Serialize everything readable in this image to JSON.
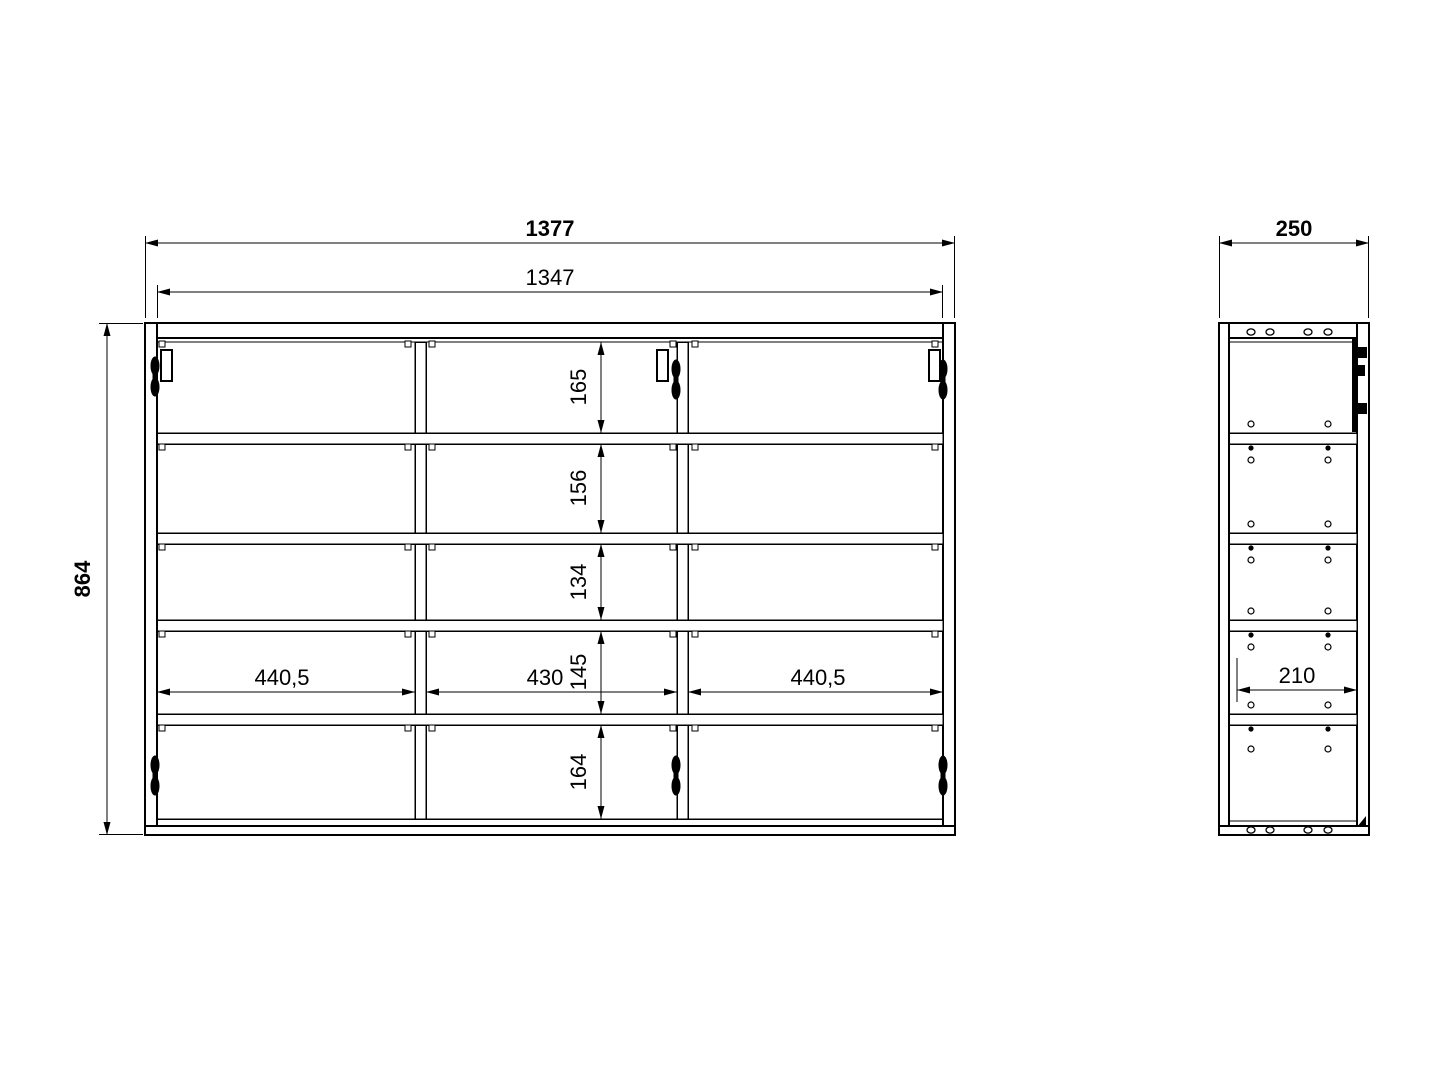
{
  "page": {
    "background": "#ffffff",
    "description": "Technical dimension drawing of a three-door wall cabinet, front view and side view"
  },
  "drawing": {
    "line_color": "#000000",
    "front_view": {
      "overall_width": "1377",
      "inner_width": "1347",
      "overall_height": "864",
      "row_heights": [
        "165",
        "156",
        "134",
        "145",
        "164"
      ],
      "compartment_widths": [
        "440,5",
        "430",
        "440,5"
      ]
    },
    "side_view": {
      "overall_depth": "250",
      "inner_depth": "210"
    }
  },
  "geometry": {
    "canvas": {
      "width": 1449,
      "height": 1086
    },
    "shapes": [
      [
        "rect",
        145,
        323,
        12,
        512,
        2,
        "front-left-side-panel"
      ],
      [
        "rect",
        943,
        323,
        12,
        512,
        2,
        "front-right-side-panel"
      ],
      [
        "rect",
        157,
        323,
        786,
        15,
        2,
        "front-top-panel"
      ],
      [
        "line",
        157,
        342,
        943,
        342,
        1,
        "front-top-panel-front-edge"
      ],
      [
        "rect",
        415,
        342,
        11,
        477,
        1.5,
        "front-divider-1"
      ],
      [
        "rect",
        677,
        342,
        11,
        477,
        1.5,
        "front-divider-2"
      ],
      [
        "rect",
        157,
        433,
        786,
        11,
        1.5,
        "front-shelf-1"
      ],
      [
        "rect",
        157,
        533,
        786,
        11,
        1.5,
        "front-shelf-2"
      ],
      [
        "rect",
        157,
        620,
        786,
        11,
        1.5,
        "front-shelf-3"
      ],
      [
        "rect",
        157,
        714,
        786,
        11,
        1.5,
        "front-shelf-4"
      ],
      [
        "line",
        157,
        819,
        943,
        819,
        1.5,
        "front-bottom-panel-top-edge"
      ],
      [
        "rect",
        145,
        826,
        810,
        9,
        2,
        "front-bottom-panel"
      ],
      [
        "rect",
        1219,
        323,
        10,
        512,
        2,
        "side-back-panel"
      ],
      [
        "rect",
        1357,
        323,
        12,
        512,
        2,
        "side-front-panel"
      ],
      [
        "rect",
        1229,
        323,
        128,
        15,
        2,
        "side-top-panel"
      ],
      [
        "line",
        1229,
        342,
        1357,
        342,
        1,
        "side-top-panel-edge"
      ],
      [
        "rect",
        1229,
        433,
        128,
        11,
        1.5,
        "side-shelf-1"
      ],
      [
        "rect",
        1229,
        533,
        128,
        11,
        1.5,
        "side-shelf-2"
      ],
      [
        "rect",
        1229,
        620,
        128,
        11,
        1.5,
        "side-shelf-3"
      ],
      [
        "rect",
        1229,
        714,
        128,
        11,
        1.5,
        "side-shelf-4"
      ],
      [
        "line",
        1229,
        821,
        1357,
        821,
        1,
        "side-bottom-panel-top-edge"
      ],
      [
        "rect",
        1219,
        826,
        150,
        9,
        2,
        "side-bottom-panel"
      ],
      [
        "fill",
        1352,
        339,
        6,
        93,
        "side-hinge-bar"
      ],
      [
        "fill",
        1358,
        347,
        9,
        11,
        "side-hinge-nub"
      ],
      [
        "fill",
        1358,
        365,
        7,
        11,
        "side-hinge-nub"
      ],
      [
        "fill",
        1358,
        403,
        9,
        11,
        "side-hinge-nub"
      ],
      [
        "tri",
        "1357,827 1366,816 1366,827",
        "side-door-stop-wedge"
      ]
    ],
    "support_squares": {
      "rows": [
        341,
        444,
        544,
        631,
        725
      ],
      "cols": [
        159,
        405,
        429,
        670,
        692,
        932
      ],
      "size": 6
    },
    "side_holes": {
      "row_x": [
        1251,
        1270,
        1308,
        1328
      ],
      "row_y": [
        332,
        830
      ],
      "pair_x": [
        1251,
        1328
      ],
      "open_y": [
        424,
        460,
        524,
        560,
        611,
        647,
        705,
        749
      ],
      "filled_y": [
        448,
        548,
        635,
        729
      ]
    },
    "hinge_blobs": [
      [
        155,
        357
      ],
      [
        676,
        360
      ],
      [
        943,
        360
      ],
      [
        155,
        756
      ],
      [
        676,
        756
      ],
      [
        943,
        756
      ]
    ],
    "hinge_plates": [
      [
        161,
        350
      ],
      [
        657,
        350
      ],
      [
        929,
        350
      ]
    ],
    "dims": [
      {
        "o": "h",
        "x1": 145,
        "x2": 955,
        "y": 243,
        "ref": "front_view.overall_width",
        "bold": true,
        "tx": 550,
        "ty": 236,
        "ext": [
          [
            145.5,
            236,
            145.5,
            318
          ],
          [
            954.5,
            236,
            954.5,
            318
          ]
        ],
        "name": "dim-front-overall-width"
      },
      {
        "o": "h",
        "x1": 157,
        "x2": 943,
        "y": 292,
        "ref": "front_view.inner_width",
        "tx": 550,
        "ty": 285,
        "ext": [
          [
            157.5,
            285,
            157.5,
            318
          ],
          [
            942.5,
            285,
            942.5,
            318
          ]
        ],
        "name": "dim-front-inner-width"
      },
      {
        "o": "v",
        "y1": 323,
        "y2": 835,
        "x": 107,
        "ref": "front_view.overall_height",
        "bold": true,
        "tx": 90,
        "ty": 579,
        "rot": true,
        "ext": [
          [
            99,
            323.5,
            143,
            323.5
          ],
          [
            99,
            834.5,
            143,
            834.5
          ]
        ],
        "name": "dim-front-overall-height"
      },
      {
        "o": "v",
        "y1": 342,
        "y2": 433,
        "x": 601,
        "ref": "front_view.row_heights.0",
        "tx": 586,
        "ty": 387,
        "rot": true,
        "name": "dim-row-1-height"
      },
      {
        "o": "v",
        "y1": 444,
        "y2": 533,
        "x": 601,
        "ref": "front_view.row_heights.1",
        "tx": 586,
        "ty": 488,
        "rot": true,
        "name": "dim-row-2-height"
      },
      {
        "o": "v",
        "y1": 544,
        "y2": 620,
        "x": 601,
        "ref": "front_view.row_heights.2",
        "tx": 586,
        "ty": 582,
        "rot": true,
        "name": "dim-row-3-height"
      },
      {
        "o": "v",
        "y1": 631,
        "y2": 714,
        "x": 601,
        "ref": "front_view.row_heights.3",
        "tx": 586,
        "ty": 672,
        "rot": true,
        "name": "dim-row-4-height"
      },
      {
        "o": "v",
        "y1": 725,
        "y2": 819,
        "x": 601,
        "ref": "front_view.row_heights.4",
        "tx": 586,
        "ty": 772,
        "rot": true,
        "name": "dim-row-5-height"
      },
      {
        "o": "h",
        "x1": 157,
        "x2": 415,
        "y": 692,
        "ref": "front_view.compartment_widths.0",
        "tx": 282,
        "ty": 685,
        "name": "dim-compartment-left-width"
      },
      {
        "o": "h",
        "x1": 426,
        "x2": 677,
        "y": 692,
        "ref": "front_view.compartment_widths.1",
        "tx": 545,
        "ty": 685,
        "name": "dim-compartment-middle-width"
      },
      {
        "o": "h",
        "x1": 688,
        "x2": 943,
        "y": 692,
        "ref": "front_view.compartment_widths.2",
        "tx": 818,
        "ty": 685,
        "name": "dim-compartment-right-width"
      },
      {
        "o": "h",
        "x1": 1219,
        "x2": 1369,
        "y": 243,
        "ref": "side_view.overall_depth",
        "bold": true,
        "tx": 1294,
        "ty": 236,
        "ext": [
          [
            1219.5,
            236,
            1219.5,
            318
          ],
          [
            1368.5,
            236,
            1368.5,
            318
          ]
        ],
        "name": "dim-side-overall-depth"
      },
      {
        "o": "h",
        "x1": 1237,
        "x2": 1357,
        "y": 690,
        "ref": "side_view.inner_depth",
        "tx": 1297,
        "ty": 683,
        "ext": [
          [
            1237,
            658,
            1237,
            702
          ]
        ],
        "name": "dim-side-inner-depth"
      }
    ]
  }
}
